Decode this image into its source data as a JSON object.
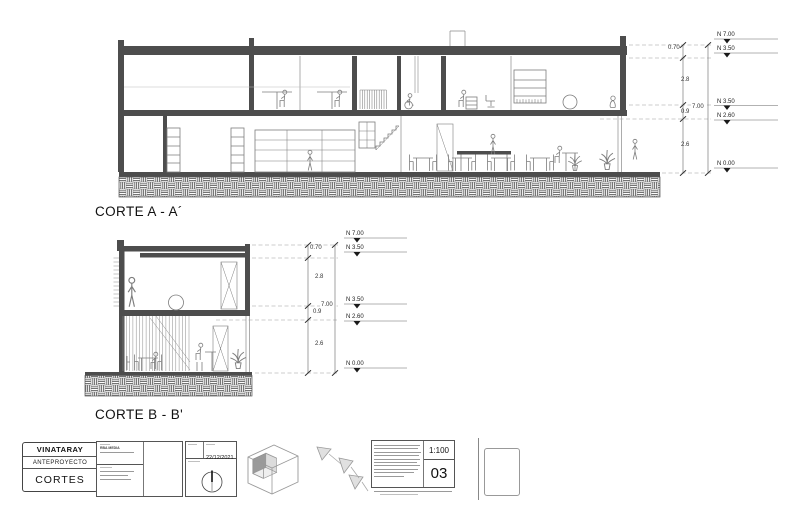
{
  "sections": [
    {
      "title": "CORTE A - A´",
      "dims": [
        "0.70",
        "2.8",
        "7.00",
        "0.9",
        "2.6"
      ],
      "levels": [
        "N 7.00",
        "N 3.50",
        "N 3.50",
        "N 2.60",
        "N 0.00"
      ]
    },
    {
      "title": "CORTE B - B'",
      "dims": [
        "0.70",
        "2.8",
        "7.00",
        "0.9",
        "2.6"
      ],
      "levels": [
        "N 7.00",
        "N 3.50",
        "N 3.50",
        "N 2.60",
        "N 0.00"
      ]
    }
  ],
  "title_block": {
    "project": "VINATARAY",
    "phase": "ANTEPROYECTO",
    "sheet_title": "CORTES",
    "author": "RBA MEDIA",
    "date": "22/12/2021",
    "scale": "1:100",
    "sheet_number": "03"
  },
  "colors": {
    "slab": "#4d4d4d",
    "line": "#808080",
    "dim_line": "#555555"
  }
}
